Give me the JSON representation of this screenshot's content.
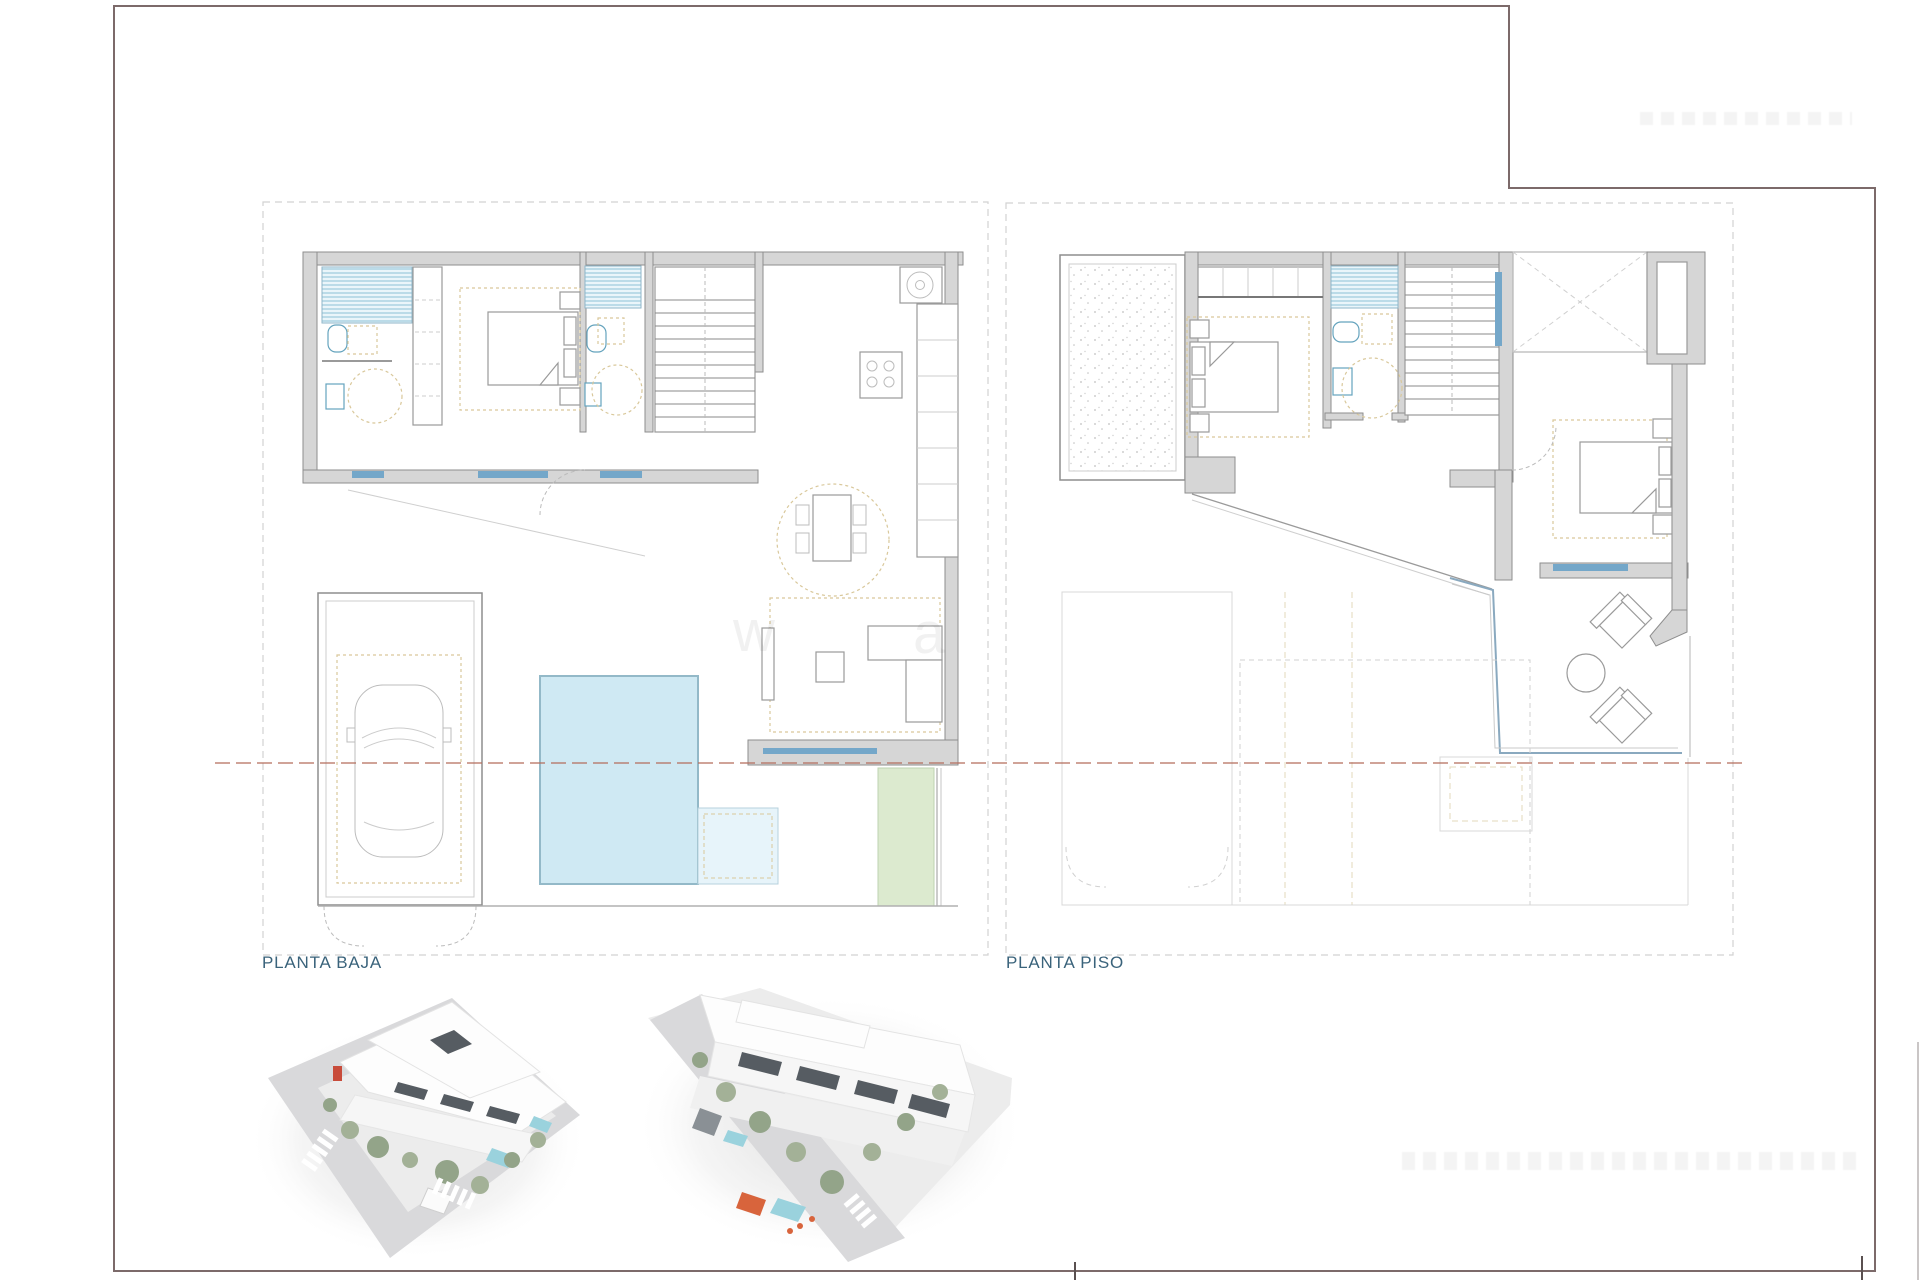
{
  "sheet": {
    "background": "#ffffff"
  },
  "plans": [
    {
      "id": "planta-baja",
      "label": "PLANTA BAJA"
    },
    {
      "id": "planta-piso",
      "label": "PLANTA PISO"
    }
  ],
  "watermark": {
    "letters": [
      "w",
      "a"
    ]
  },
  "colors": {
    "border": "#7c6a6a",
    "frame_dash": "#d2d2d2",
    "wall": "#d6d6d6",
    "wall_stroke": "#8e8e8e",
    "hatch_bg": "#eaf5fa",
    "hatch_line": "#8cc1d6",
    "window": "#74a7c9",
    "pool": "#cfe9f3",
    "pool_stroke": "#93b9c8",
    "pool_step": "#e7f4fa",
    "lawn": "#dceacf",
    "lawn_stroke": "#bed3b0",
    "furniture_dash": "#d9c89b",
    "boundary_dash": "#b5705f",
    "fixture": "#64a3bd",
    "label": "#3a637b",
    "ghost": "#d8d8d8",
    "stipple": "#c0c0c0",
    "street": "#d9d9db",
    "sidewalk": "#ececec",
    "building_edge": "#e3e3e3",
    "window_dark": "#565c62",
    "tree": "#93a489",
    "tree2": "#a3b197",
    "pool_render": "#9ad2dd",
    "accent_red": "#c84b3a",
    "accent_orange": "#d8643c",
    "car_gray": "#8a9095"
  }
}
